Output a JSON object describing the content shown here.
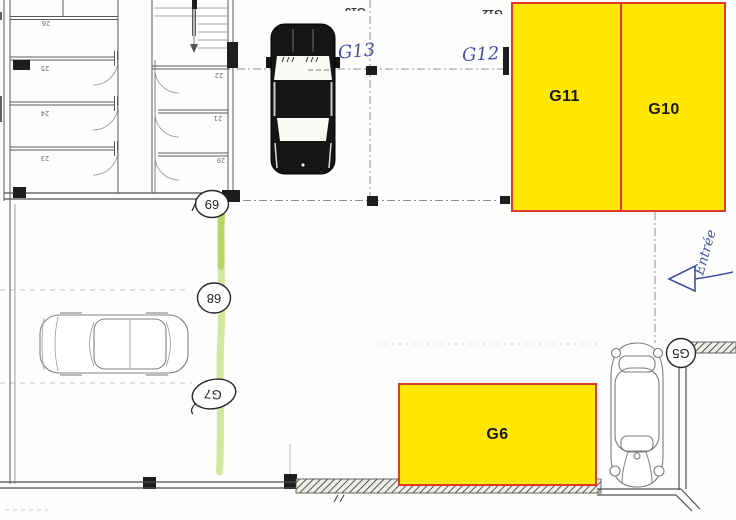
{
  "plan": {
    "garage_boxes": {
      "g11": "G11",
      "g10": "G10",
      "g6": "G6"
    },
    "handwriting": {
      "g13": "G13",
      "g12": "G12",
      "entree": "Entrée"
    },
    "printed_top_labels": {
      "g13": "G13",
      "g12": "G12"
    },
    "circled_spot_labels": {
      "n69": "69",
      "n68": "68",
      "g7": "G7",
      "g5": "G5"
    },
    "cellar_room_numbers": {
      "r26": "26",
      "r25": "25",
      "r24": "24",
      "r23": "23",
      "r22": "22",
      "r21": "21",
      "r20": "20"
    },
    "colors": {
      "highlight_fill": "#ffe605",
      "highlight_border": "#e0392b",
      "ink_blue": "#4350a2",
      "marker_green": "#a9cf3f"
    }
  }
}
